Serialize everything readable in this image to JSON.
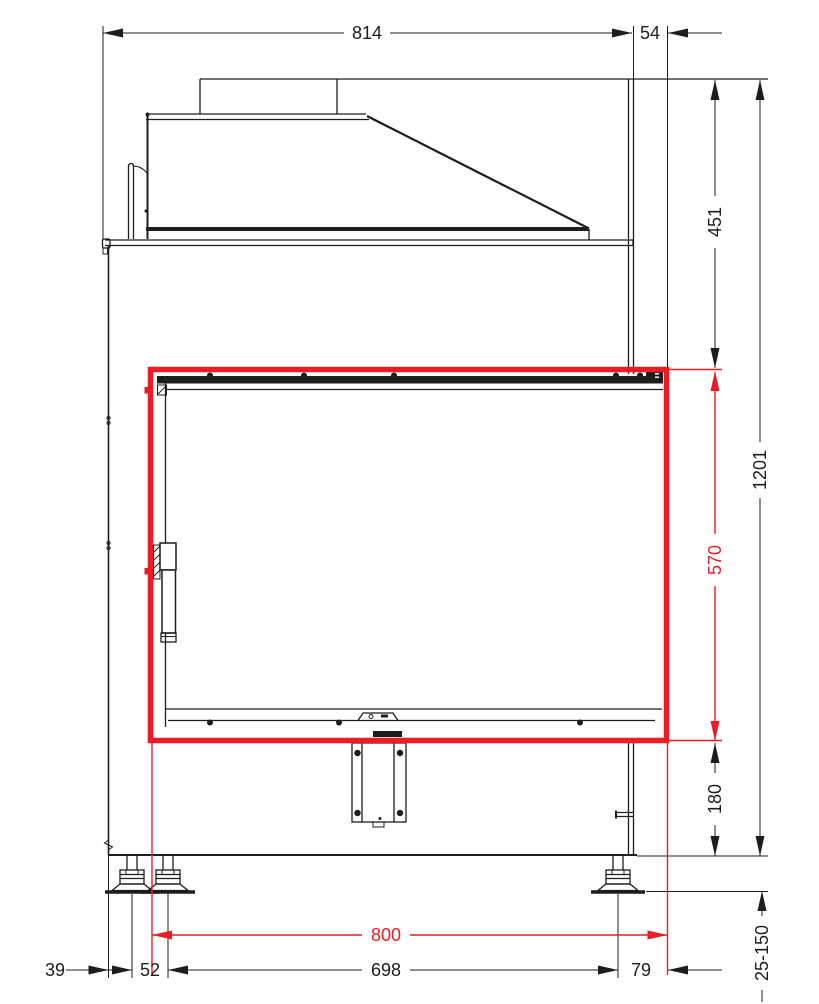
{
  "drawing": {
    "type": "fireplace-insert-front-elevation",
    "dimensions": {
      "overall_width": "814",
      "rear_offset": "54",
      "top_section_height": "451",
      "overall_height": "1201",
      "frame_height": "570",
      "base_section_height": "180",
      "foot_adjust_range": "25-150",
      "edge_to_foot": "39",
      "front_feet_spacing": "52",
      "feet_span": "698",
      "foot_to_frame": "79",
      "frame_width": "800"
    }
  },
  "colors": {
    "highlight_red": "#ed1c24",
    "line_ink": "#1d1d1b",
    "background": "#ffffff"
  }
}
